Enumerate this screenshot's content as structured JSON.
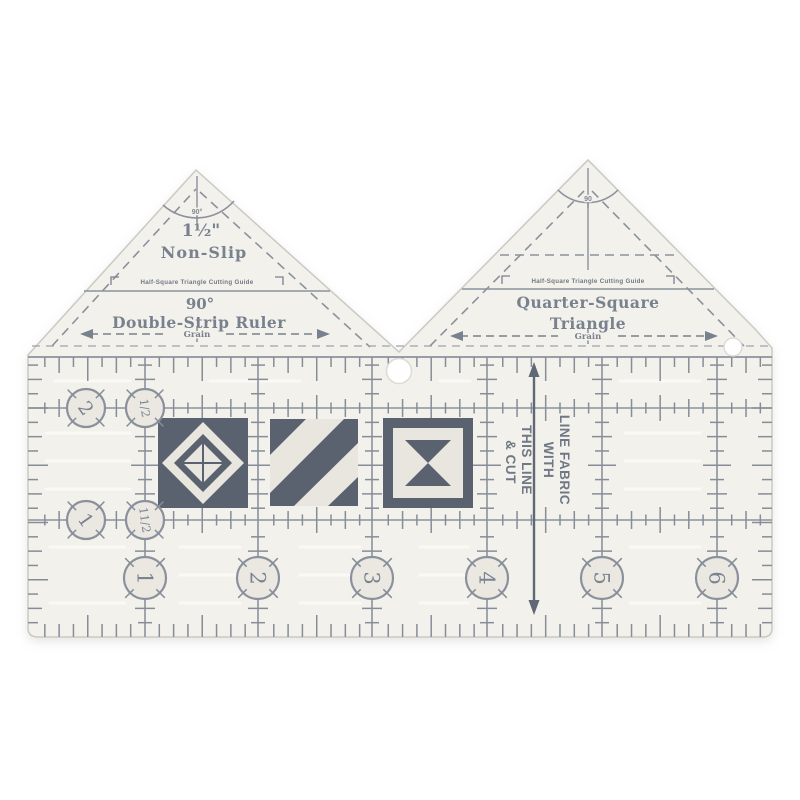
{
  "colors": {
    "background": "#ffffff",
    "ruler_fill": "#f3f1eb",
    "marking_grey": "#78818e",
    "line_grey": "#8b919c",
    "tick_grey": "#868d98",
    "patch_dark": "#5a6270",
    "patch_light": "#e9e6df",
    "circle_fill": "#eae8e1"
  },
  "left_triangle": {
    "apex_angle": "90°",
    "size": "1½\"",
    "grip_label": "Non-Slip",
    "cutting_guide": "Half-Square Triangle Cutting Guide",
    "angle_label": "90°",
    "ruler_name": "Double-Strip Ruler",
    "grain_label": "Grain"
  },
  "right_triangle": {
    "apex_angle": "90",
    "cutting_guide": "Half-Square Triangle Cutting Guide",
    "name_line1": "Quarter-Square",
    "name_line2": "Triangle",
    "grain_label": "Grain"
  },
  "body": {
    "cut_line_lines": [
      "LINE FABRIC",
      "WITH",
      "THIS LINE",
      "& CUT"
    ],
    "left_scale": [
      "2",
      "1/2",
      "1",
      "11/2"
    ],
    "bottom_scale": [
      "1",
      "2",
      "3",
      "4",
      "5",
      "6"
    ]
  }
}
